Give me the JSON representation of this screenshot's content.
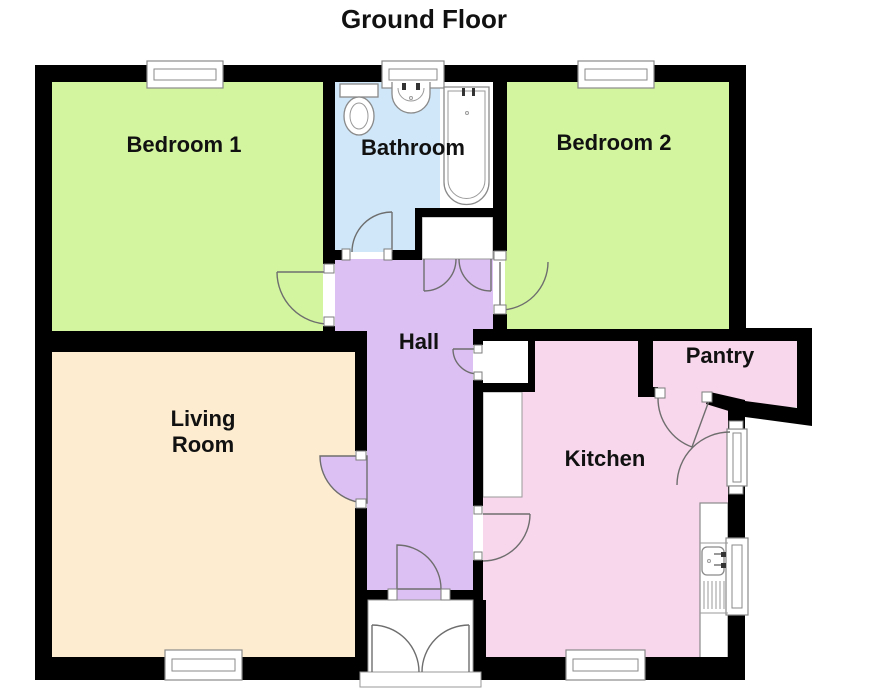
{
  "title": "Ground Floor",
  "rooms": {
    "bedroom1": {
      "label": "Bedroom 1",
      "color": "#d3f59f"
    },
    "bathroom": {
      "label": "Bathroom",
      "color": "#cfe7f8"
    },
    "bedroom2": {
      "label": "Bedroom 2",
      "color": "#d3f59f"
    },
    "hall": {
      "label": "Hall",
      "color": "#ddc0f3"
    },
    "living_room": {
      "line1": "Living",
      "line2": "Room",
      "color": "#fdeccf"
    },
    "kitchen": {
      "label": "Kitchen",
      "color": "#f8d6eb"
    },
    "pantry": {
      "label": "Pantry",
      "color": "#f8d6eb"
    }
  },
  "colors": {
    "wall": "#000000",
    "background": "#ffffff",
    "door_arc": "#6e6e6e",
    "fixture_outline": "#8a8a8a",
    "label_text": "#111111"
  }
}
